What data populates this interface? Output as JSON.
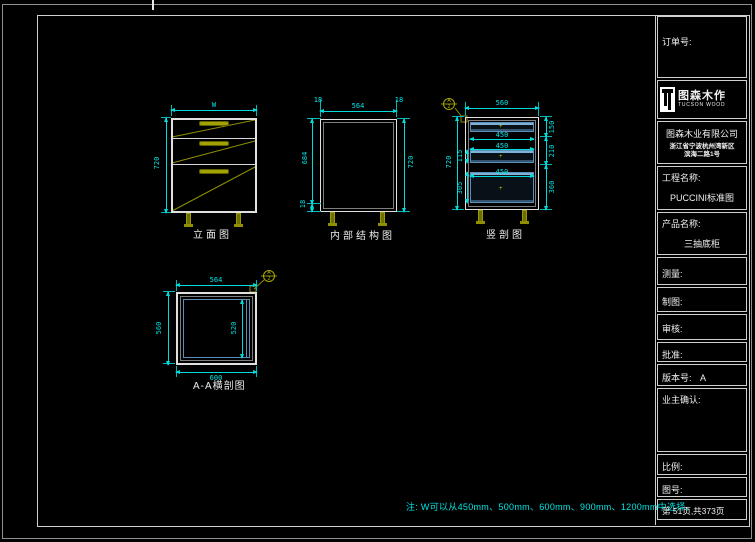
{
  "sheet": {
    "note": "注: W可以从450mm、500mm、600mm、900mm、1200mm中选择。"
  },
  "title_block": {
    "order_label": "订单号:",
    "brand": {
      "name_cn": "图森木作",
      "name_en": "TUCSON WOOD"
    },
    "company": {
      "name": "图森木业有限公司",
      "address_line1": "浙江省宁波杭州湾新区",
      "address_line2": "滨海二路1号"
    },
    "project_label": "工程名称:",
    "project_value": "PUCCINI标准图",
    "product_label": "产品名称:",
    "product_value": "三抽底柜",
    "measure_label": "测量:",
    "draft_label": "制图:",
    "check_label": "审核:",
    "approve_label": "批准:",
    "version_label": "版本号:",
    "version_value": "A",
    "owner_confirm_label": "业主确认:",
    "scale_label": "比例:",
    "drawing_no_label": "图号:",
    "page_info": "第 51页,共373页"
  },
  "drawings": {
    "elevation": {
      "title": "立面图",
      "dim_width": "W",
      "dim_height": "720"
    },
    "internal": {
      "title": "内部结构图",
      "dim_inner_width": "564",
      "dim_top_left": "18",
      "dim_top_right": "18",
      "dim_inner_height": "684",
      "dim_bottom_panel": "18",
      "dim_height": "720"
    },
    "vertical_section": {
      "title": "竖剖图",
      "dim_depth": "560",
      "dim_height": "720",
      "dim_right_top": "150",
      "dim_right_mid": "210",
      "dim_right_bottom": "360",
      "dim_drawer1_w": "450",
      "dim_drawer2_w": "450",
      "dim_drawer3_w": "450",
      "dim_drawer2_h": "115",
      "dim_drawer3_h": "305",
      "marker_letter": "A",
      "marker_number": "2"
    },
    "horizontal_section": {
      "title": "A-A横剖图",
      "dim_inner_width": "564",
      "dim_width": "600",
      "dim_depth": "560",
      "dim_inner_depth": "520",
      "marker_letter": "A",
      "marker_number": "2"
    }
  },
  "colors": {
    "dimension": "#00E0E0",
    "hardware": "#8F8F00",
    "drawer": "#5B8FB8",
    "line": "#E0E0E0"
  }
}
